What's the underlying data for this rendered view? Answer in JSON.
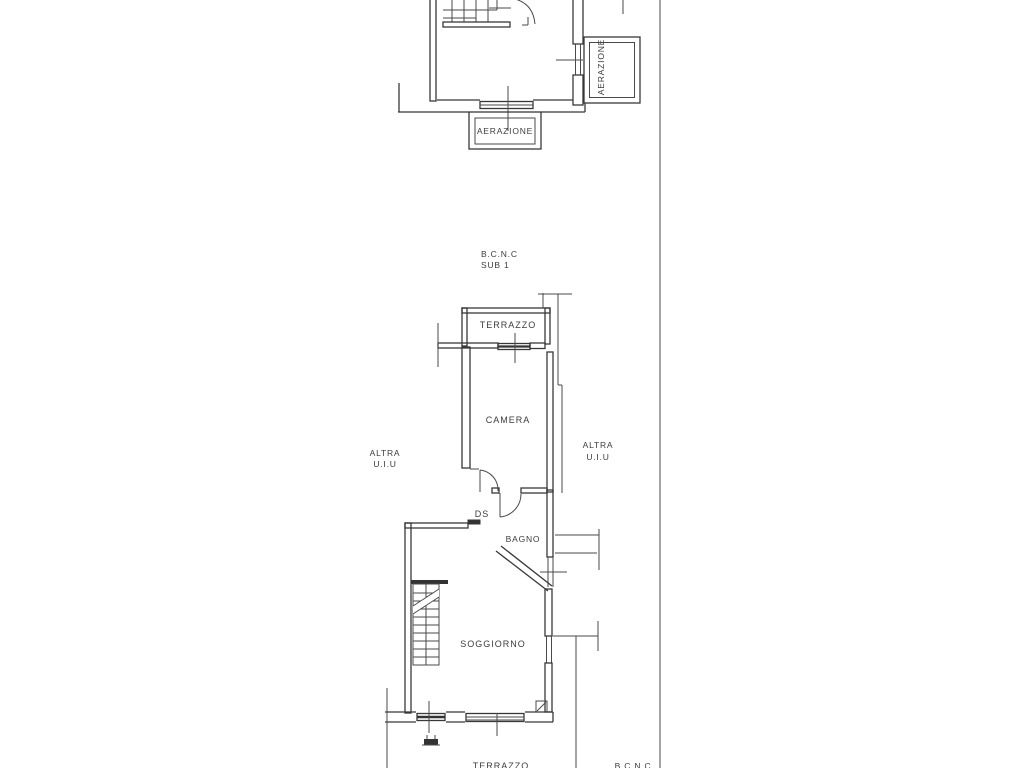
{
  "document": {
    "type": "cadastral-floor-plan",
    "paper_color": "#ffffff",
    "ink_color": "#383838"
  },
  "labels": {
    "aerazione_right": "AERAZIONE",
    "aerazione_bottom": "AERAZIONE",
    "bcnc_top_line1": "B.C.N.C",
    "bcnc_top_line2": "SUB 1",
    "terrazzo_top": "TERRAZZO",
    "camera": "CAMERA",
    "altra_left_line1": "ALTRA",
    "altra_left_line2": "U.I.U",
    "altra_right_line1": "ALTRA",
    "altra_right_line2": "U.I.U",
    "ds": "DS",
    "bagno": "BAGNO",
    "soggiorno": "SOGGIORNO",
    "terrazzo_bottom": "TERRAZZO",
    "bcnc_bottom": "B.C.N.C"
  }
}
